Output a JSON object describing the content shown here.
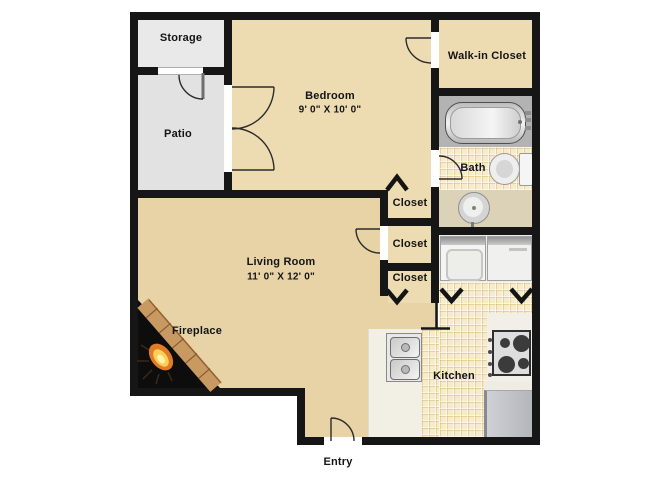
{
  "rooms": {
    "storage": {
      "label": "Storage"
    },
    "patio": {
      "label": "Patio"
    },
    "bedroom": {
      "label": "Bedroom",
      "dimensions": "9' 0\" X 10' 0\""
    },
    "walk_in_closet": {
      "label": "Walk-in Closet"
    },
    "bath": {
      "label": "Bath"
    },
    "closet_top": {
      "label": "Closet"
    },
    "closet_middle": {
      "label": "Closet"
    },
    "closet_bottom": {
      "label": "Closet"
    },
    "living_room": {
      "label": "Living Room",
      "dimensions": "11' 0\" X 12' 0\""
    },
    "fireplace": {
      "label": "Fireplace"
    },
    "kitchen": {
      "label": "Kitchen"
    },
    "entry": {
      "label": "Entry"
    }
  },
  "fixtures": [
    "bathtub",
    "toilet",
    "vanity-sink",
    "washer",
    "dryer",
    "kitchen-sink",
    "stove-cooktop",
    "refrigerator",
    "fireplace-flame",
    "door-swing",
    "bifold-door-chevron"
  ],
  "colors": {
    "wall": "#161616",
    "bedroom_floor": "#eddcb2",
    "living_floor": "#e7d3a6",
    "patio_floor": "#e2e2e2",
    "storage_floor": "#e9e9e9",
    "tile_floor": "#f6ecca",
    "tile_grid": "#d2a564",
    "bath_counter": "#dbd2b8",
    "tub_surround": "#b3b3b3",
    "laundry_floor": "#edece6",
    "kitchen_counter": "#f2efe4",
    "fridge": "#c0c4c9",
    "brick": "#c89a62",
    "flame": "#f5a53c"
  }
}
